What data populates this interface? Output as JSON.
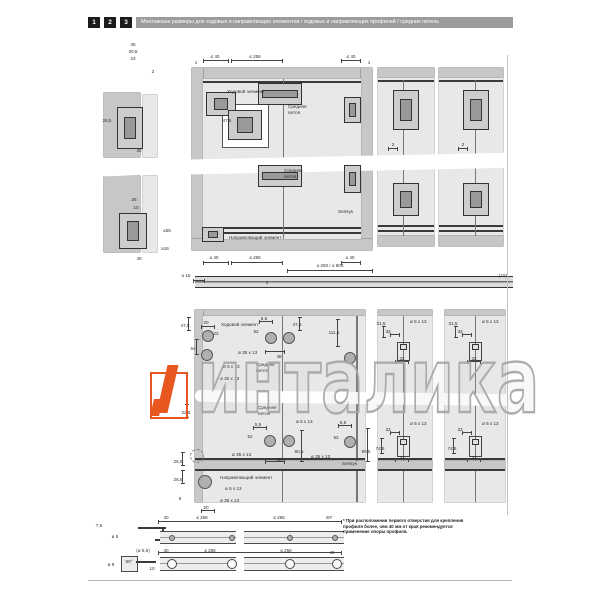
{
  "header": {
    "steps": [
      "1",
      "2",
      "3"
    ],
    "title": "Монтажные размеры для ходовых и направляющих элементов / ходовых и направляющих профилей / средних петель"
  },
  "watermark": {
    "text": "инталика",
    "accent_color": "#e8571f",
    "outline_color": "#a6a6a6"
  },
  "note": {
    "lines": [
      "* При расположении первого отверстия для крепления",
      "профиля более, чем 40 мм от края рекомендуется",
      "применение опоры профиля."
    ]
  },
  "labels": {
    "runner": "Ходовой элемент",
    "middle_hinge": "Средняя петля",
    "guide": "Направляющий элемент",
    "hinge_brand": "Sensys"
  },
  "annotations": [
    {
      "t": "36",
      "x": 133,
      "y": 42,
      "c": "d"
    },
    {
      "t": "30,5",
      "x": 133,
      "y": 49,
      "c": "d"
    },
    {
      "t": "23",
      "x": 133,
      "y": 56,
      "c": "d"
    },
    {
      "t": "2",
      "x": 153,
      "y": 69,
      "c": "d"
    },
    {
      "t": "26,5",
      "x": 107,
      "y": 118,
      "c": "d"
    },
    {
      "t": "40",
      "x": 139,
      "y": 148,
      "c": "d"
    },
    {
      "t": "26",
      "x": 134,
      "y": 197,
      "c": "d"
    },
    {
      "t": "10",
      "x": 136,
      "y": 205,
      "c": "d"
    },
    {
      "t": "≤55",
      "x": 167,
      "y": 228,
      "c": "d"
    },
    {
      "t": "≥16",
      "x": 165,
      "y": 246,
      "c": "d"
    },
    {
      "t": "40",
      "x": 139,
      "y": 256,
      "c": "d"
    },
    {
      "t": "1",
      "x": 196,
      "y": 60,
      "c": "d"
    },
    {
      "t": "≤ 40",
      "x": 215,
      "y": 54,
      "c": "d"
    },
    {
      "t": "≤ 256",
      "x": 255,
      "y": 54,
      "c": "d"
    },
    {
      "t": "≤ 40",
      "x": 351,
      "y": 54,
      "c": "d"
    },
    {
      "t": "1",
      "x": 369,
      "y": 60,
      "c": "d"
    },
    {
      "t": "Ходовой элемент",
      "x": 227,
      "y": 89,
      "c": "l"
    },
    {
      "t": "47,5",
      "x": 227,
      "y": 118,
      "c": "d"
    },
    {
      "t": "Средняя",
      "x": 288,
      "y": 104,
      "c": "l"
    },
    {
      "t": "петля",
      "x": 288,
      "y": 110,
      "c": "l"
    },
    {
      "t": "Средняя",
      "x": 284,
      "y": 168,
      "c": "l"
    },
    {
      "t": "петля",
      "x": 284,
      "y": 174,
      "c": "l"
    },
    {
      "t": "Sensys",
      "x": 338,
      "y": 209,
      "c": "l"
    },
    {
      "t": "Направляющий элемент",
      "x": 229,
      "y": 235,
      "c": "l"
    },
    {
      "t": "≤ 40",
      "x": 214,
      "y": 255,
      "c": "d"
    },
    {
      "t": "≤ 256",
      "x": 255,
      "y": 255,
      "c": "d"
    },
    {
      "t": "≤ 40",
      "x": 350,
      "y": 255,
      "c": "d"
    },
    {
      "t": "≥ 250 / ≤ 600",
      "x": 330,
      "y": 263,
      "c": "d"
    },
    {
      "t": "≤ 15",
      "x": 186,
      "y": 273,
      "c": "d"
    },
    {
      "t": "2",
      "x": 267,
      "y": 280,
      "c": "d"
    },
    {
      "t": "(15)",
      "x": 503,
      "y": 273,
      "c": "d"
    },
    {
      "t": "2",
      "x": 393,
      "y": 142,
      "c": "d"
    },
    {
      "t": "2",
      "x": 463,
      "y": 142,
      "c": "d"
    },
    {
      "t": "47,5",
      "x": 185,
      "y": 323,
      "c": "d"
    },
    {
      "t": "20",
      "x": 206,
      "y": 320,
      "c": "d"
    },
    {
      "t": "Ходовой элемент",
      "x": 221,
      "y": 322,
      "c": "l"
    },
    {
      "t": "22",
      "x": 216,
      "y": 331,
      "c": "d"
    },
    {
      "t": "64",
      "x": 193,
      "y": 346,
      "c": "d"
    },
    {
      "t": "ø 35 x 13",
      "x": 238,
      "y": 350,
      "c": "l"
    },
    {
      "t": "ø 5 x 13",
      "x": 223,
      "y": 364,
      "c": "l"
    },
    {
      "t": "ø 35 x 13",
      "x": 220,
      "y": 376,
      "c": "l"
    },
    {
      "t": "Средняя",
      "x": 256,
      "y": 362,
      "c": "l"
    },
    {
      "t": "петля",
      "x": 256,
      "y": 368,
      "c": "l"
    },
    {
      "t": "5,5",
      "x": 264,
      "y": 316,
      "c": "d"
    },
    {
      "t": "52",
      "x": 256,
      "y": 329,
      "c": "d"
    },
    {
      "t": "48",
      "x": 279,
      "y": 354,
      "c": "d"
    },
    {
      "t": "47,6",
      "x": 297,
      "y": 322,
      "c": "d"
    },
    {
      "t": "111,5",
      "x": 334,
      "y": 330,
      "c": "d"
    },
    {
      "t": "31,5",
      "x": 381,
      "y": 321,
      "c": "d"
    },
    {
      "t": "32",
      "x": 388,
      "y": 329,
      "c": "d"
    },
    {
      "t": "ø 5 x 13",
      "x": 410,
      "y": 319,
      "c": "l"
    },
    {
      "t": "32",
      "x": 402,
      "y": 356,
      "c": "d"
    },
    {
      "t": "31,5",
      "x": 453,
      "y": 321,
      "c": "d"
    },
    {
      "t": "32",
      "x": 460,
      "y": 329,
      "c": "d"
    },
    {
      "t": "ø 5 x 13",
      "x": 482,
      "y": 319,
      "c": "l"
    },
    {
      "t": "32",
      "x": 474,
      "y": 356,
      "c": "d"
    },
    {
      "t": "Средняя",
      "x": 258,
      "y": 405,
      "c": "l"
    },
    {
      "t": "петля",
      "x": 258,
      "y": 411,
      "c": "l"
    },
    {
      "t": "5,5",
      "x": 258,
      "y": 422,
      "c": "d"
    },
    {
      "t": "52",
      "x": 250,
      "y": 434,
      "c": "d"
    },
    {
      "t": "ø 5 x 13",
      "x": 296,
      "y": 419,
      "c": "l"
    },
    {
      "t": "ø 35 x 13",
      "x": 232,
      "y": 452,
      "c": "l"
    },
    {
      "t": "48",
      "x": 279,
      "y": 457,
      "c": "d"
    },
    {
      "t": "90,5",
      "x": 299,
      "y": 449,
      "c": "d"
    },
    {
      "t": "5,5",
      "x": 343,
      "y": 420,
      "c": "d"
    },
    {
      "t": "52",
      "x": 336,
      "y": 435,
      "c": "d"
    },
    {
      "t": "ø 35 x 13",
      "x": 311,
      "y": 454,
      "c": "l"
    },
    {
      "t": "90,5",
      "x": 366,
      "y": 449,
      "c": "d"
    },
    {
      "t": "Sensys",
      "x": 342,
      "y": 461,
      "c": "l"
    },
    {
      "t": "22,5",
      "x": 186,
      "y": 410,
      "c": "d"
    },
    {
      "t": "26,5",
      "x": 178,
      "y": 459,
      "c": "d"
    },
    {
      "t": "26,5",
      "x": 178,
      "y": 477,
      "c": "d"
    },
    {
      "t": "Направляющий элемент",
      "x": 220,
      "y": 475,
      "c": "l"
    },
    {
      "t": "ø 5 x 13",
      "x": 225,
      "y": 486,
      "c": "l"
    },
    {
      "t": "ø 35 x 13",
      "x": 220,
      "y": 498,
      "c": "l"
    },
    {
      "t": "5",
      "x": 180,
      "y": 496,
      "c": "d"
    },
    {
      "t": "20",
      "x": 206,
      "y": 505,
      "c": "d"
    },
    {
      "t": "32",
      "x": 388,
      "y": 427,
      "c": "d"
    },
    {
      "t": "ø 5 x 13",
      "x": 410,
      "y": 421,
      "c": "l"
    },
    {
      "t": "74,5",
      "x": 380,
      "y": 446,
      "c": "d"
    },
    {
      "t": "32",
      "x": 402,
      "y": 455,
      "c": "d"
    },
    {
      "t": "32",
      "x": 460,
      "y": 427,
      "c": "d"
    },
    {
      "t": "ø 5 x 13",
      "x": 482,
      "y": 421,
      "c": "l"
    },
    {
      "t": "74,5",
      "x": 452,
      "y": 446,
      "c": "d"
    },
    {
      "t": "32",
      "x": 474,
      "y": 455,
      "c": "d"
    },
    {
      "t": "7,6",
      "x": 99,
      "y": 523,
      "c": "d"
    },
    {
      "t": "ø 5",
      "x": 115,
      "y": 534,
      "c": "d"
    },
    {
      "t": "40",
      "x": 166,
      "y": 515,
      "c": "d"
    },
    {
      "t": "≤ 256",
      "x": 202,
      "y": 515,
      "c": "d"
    },
    {
      "t": "≤ 256",
      "x": 279,
      "y": 515,
      "c": "d"
    },
    {
      "t": "40*",
      "x": 329,
      "y": 515,
      "c": "d"
    },
    {
      "t": "(ø 5,6)",
      "x": 143,
      "y": 548,
      "c": "d"
    },
    {
      "t": "90°",
      "x": 129,
      "y": 559,
      "c": "d"
    },
    {
      "t": "ø 9",
      "x": 111,
      "y": 562,
      "c": "d"
    },
    {
      "t": "10",
      "x": 152,
      "y": 566,
      "c": "d"
    },
    {
      "t": "40",
      "x": 166,
      "y": 548,
      "c": "d"
    },
    {
      "t": "≤ 256",
      "x": 210,
      "y": 548,
      "c": "d"
    },
    {
      "t": "≤ 256",
      "x": 286,
      "y": 548,
      "c": "d"
    },
    {
      "t": "40",
      "x": 332,
      "y": 550,
      "c": "d"
    }
  ],
  "holes": [
    {
      "x": 208,
      "y": 336,
      "r": 6
    },
    {
      "x": 207,
      "y": 355,
      "r": 6
    },
    {
      "x": 271,
      "y": 338,
      "r": 6
    },
    {
      "x": 289,
      "y": 338,
      "r": 6
    },
    {
      "x": 350,
      "y": 358,
      "r": 6
    },
    {
      "x": 270,
      "y": 441,
      "r": 6
    },
    {
      "x": 289,
      "y": 441,
      "r": 6
    },
    {
      "x": 350,
      "y": 442,
      "r": 6
    },
    {
      "x": 197,
      "y": 456,
      "r": 7,
      "k": "dashed"
    },
    {
      "x": 205,
      "y": 482,
      "r": 7
    },
    {
      "x": 172,
      "y": 538,
      "r": 3
    },
    {
      "x": 232,
      "y": 538,
      "r": 3
    },
    {
      "x": 290,
      "y": 538,
      "r": 3
    },
    {
      "x": 335,
      "y": 538,
      "r": 3
    },
    {
      "x": 172,
      "y": 564,
      "r": 5,
      "k": "ring"
    },
    {
      "x": 232,
      "y": 564,
      "r": 5,
      "k": "ring"
    },
    {
      "x": 290,
      "y": 564,
      "r": 5,
      "k": "ring"
    },
    {
      "x": 337,
      "y": 564,
      "r": 5,
      "k": "ring"
    }
  ],
  "hardware": [
    {
      "x": 117,
      "y": 107,
      "w": 26,
      "h": 42,
      "k": "v"
    },
    {
      "x": 119,
      "y": 213,
      "w": 28,
      "h": 36,
      "k": "v"
    },
    {
      "x": 206,
      "y": 92,
      "w": 30,
      "h": 24,
      "k": "r"
    },
    {
      "x": 228,
      "y": 110,
      "w": 34,
      "h": 30,
      "k": "r"
    },
    {
      "x": 258,
      "y": 83,
      "w": 44,
      "h": 22,
      "k": "h"
    },
    {
      "x": 344,
      "y": 97,
      "w": 17,
      "h": 26,
      "k": "v"
    },
    {
      "x": 258,
      "y": 165,
      "w": 44,
      "h": 22,
      "k": "h"
    },
    {
      "x": 344,
      "y": 165,
      "w": 17,
      "h": 28,
      "k": "v"
    },
    {
      "x": 202,
      "y": 227,
      "w": 22,
      "h": 15,
      "k": "r"
    },
    {
      "x": 393,
      "y": 90,
      "w": 26,
      "h": 40,
      "k": "v"
    },
    {
      "x": 463,
      "y": 90,
      "w": 26,
      "h": 40,
      "k": "v"
    },
    {
      "x": 393,
      "y": 183,
      "w": 26,
      "h": 33,
      "k": "v"
    },
    {
      "x": 463,
      "y": 183,
      "w": 26,
      "h": 33,
      "k": "v"
    },
    {
      "x": 397,
      "y": 342,
      "w": 13,
      "h": 19,
      "k": "b"
    },
    {
      "x": 469,
      "y": 342,
      "w": 13,
      "h": 19,
      "k": "b"
    },
    {
      "x": 397,
      "y": 436,
      "w": 13,
      "h": 21,
      "k": "b"
    },
    {
      "x": 469,
      "y": 436,
      "w": 13,
      "h": 21,
      "k": "b"
    }
  ],
  "dimlines": [
    {
      "x": 203,
      "y": 60,
      "l": 26,
      "v": 0
    },
    {
      "x": 231,
      "y": 60,
      "l": 52,
      "v": 0
    },
    {
      "x": 341,
      "y": 60,
      "l": 20,
      "v": 0
    },
    {
      "x": 203,
      "y": 262,
      "l": 26,
      "v": 0
    },
    {
      "x": 231,
      "y": 262,
      "l": 52,
      "v": 0
    },
    {
      "x": 341,
      "y": 262,
      "l": 20,
      "v": 0
    },
    {
      "x": 287,
      "y": 270,
      "l": 86,
      "v": 0
    },
    {
      "x": 193,
      "y": 280,
      "l": 12,
      "v": 0
    },
    {
      "x": 388,
      "y": 148,
      "l": 10,
      "v": 0
    },
    {
      "x": 458,
      "y": 148,
      "l": 10,
      "v": 0
    },
    {
      "x": 158,
      "y": 521,
      "l": 184,
      "v": 0
    },
    {
      "x": 158,
      "y": 552,
      "l": 184,
      "v": 0
    },
    {
      "x": 188,
      "y": 317,
      "l": 14,
      "v": 1
    },
    {
      "x": 196,
      "y": 339,
      "l": 16,
      "v": 1
    },
    {
      "x": 299,
      "y": 317,
      "l": 14,
      "v": 1
    },
    {
      "x": 337,
      "y": 319,
      "l": 28,
      "v": 1
    },
    {
      "x": 301,
      "y": 430,
      "l": 32,
      "v": 1
    },
    {
      "x": 367,
      "y": 428,
      "l": 34,
      "v": 1
    },
    {
      "x": 186,
      "y": 404,
      "l": 14,
      "v": 1
    },
    {
      "x": 182,
      "y": 452,
      "l": 14,
      "v": 1
    },
    {
      "x": 182,
      "y": 470,
      "l": 14,
      "v": 1
    },
    {
      "x": 201,
      "y": 326,
      "l": 14,
      "v": 0
    },
    {
      "x": 259,
      "y": 321,
      "l": 14,
      "v": 0
    },
    {
      "x": 265,
      "y": 351,
      "l": 20,
      "v": 0
    },
    {
      "x": 253,
      "y": 427,
      "l": 14,
      "v": 0
    },
    {
      "x": 265,
      "y": 461,
      "l": 20,
      "v": 0
    },
    {
      "x": 338,
      "y": 425,
      "l": 14,
      "v": 0
    },
    {
      "x": 201,
      "y": 510,
      "l": 14,
      "v": 0
    },
    {
      "x": 383,
      "y": 326,
      "l": 12,
      "v": 1
    },
    {
      "x": 455,
      "y": 326,
      "l": 12,
      "v": 1
    },
    {
      "x": 381,
      "y": 438,
      "l": 16,
      "v": 1
    },
    {
      "x": 453,
      "y": 438,
      "l": 16,
      "v": 1
    },
    {
      "x": 390,
      "y": 334,
      "l": 10,
      "v": 0
    },
    {
      "x": 462,
      "y": 334,
      "l": 10,
      "v": 0
    },
    {
      "x": 395,
      "y": 361,
      "l": 14,
      "v": 0
    },
    {
      "x": 467,
      "y": 361,
      "l": 14,
      "v": 0
    },
    {
      "x": 390,
      "y": 432,
      "l": 10,
      "v": 0
    },
    {
      "x": 462,
      "y": 432,
      "l": 10,
      "v": 0
    },
    {
      "x": 395,
      "y": 459,
      "l": 14,
      "v": 0
    },
    {
      "x": 467,
      "y": 459,
      "l": 14,
      "v": 0
    }
  ]
}
